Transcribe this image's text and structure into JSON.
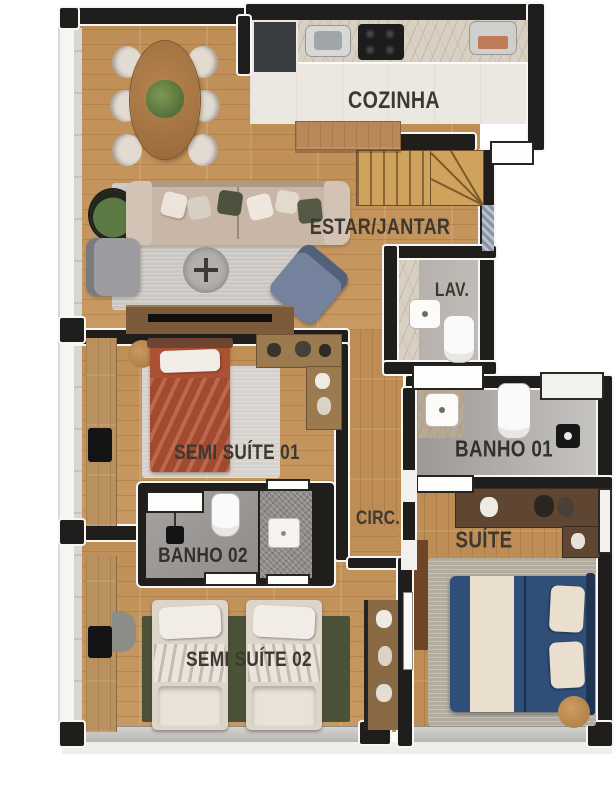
{
  "plan": {
    "type": "apartment-floor-plan-top-view",
    "rooms": {
      "cozinha": {
        "label": "COZINHA"
      },
      "estar_jantar": {
        "label": "ESTAR/JANTAR"
      },
      "lav": {
        "label": "LAV."
      },
      "semi_suite_01": {
        "label": "SEMI SUÍTE 01"
      },
      "banho_02": {
        "label": "BANHO 02"
      },
      "circ": {
        "label": "CIRC."
      },
      "banho_01": {
        "label": "BANHO 01"
      },
      "suite": {
        "label": "SUÍTE"
      },
      "semi_suite_02": {
        "label": "SEMI SUÍTE 02"
      }
    },
    "colors": {
      "background": "#ffffff",
      "wall": "#1f1e1d",
      "wall_trim": "#f7f6f3",
      "wood_floor": "#c6945a",
      "kitchen_floor": "#ece7e0",
      "bath_floor": "#a19e9c",
      "label_text": "#3d3831",
      "rug_grey": "#cbc8c3",
      "rug_green": "#4b5237",
      "bed_terracotta": "#ad5135",
      "bed_navy": "#2f4f78",
      "bed_cream": "#ded5ca",
      "marble_counter": "#d9d0c4"
    }
  }
}
